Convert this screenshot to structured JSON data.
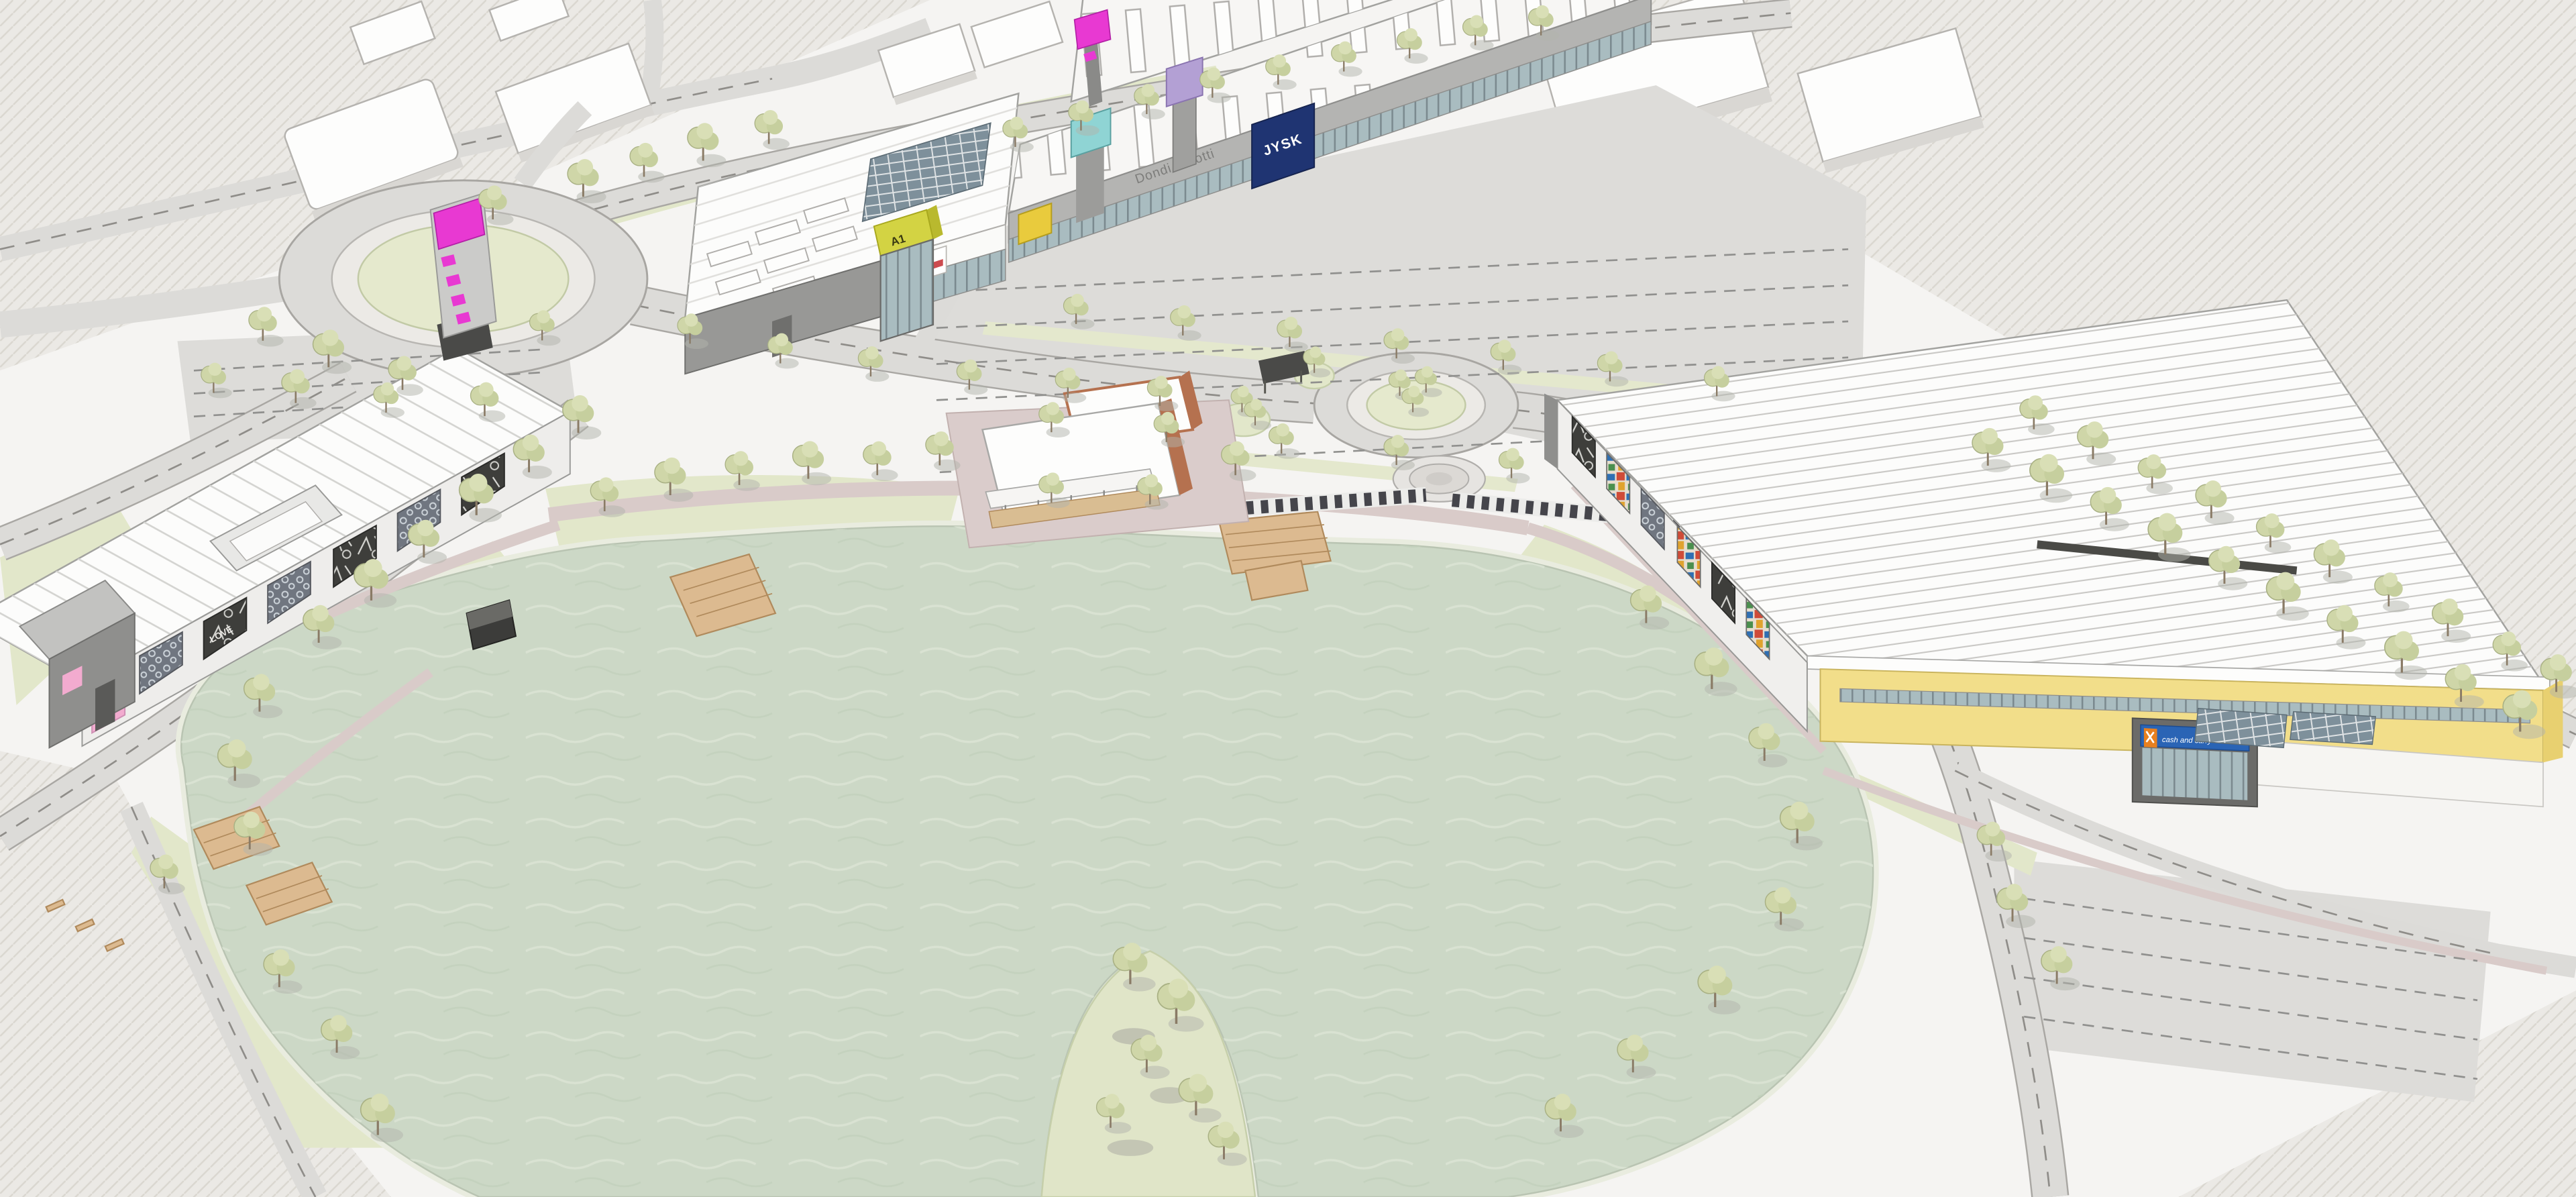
{
  "signs": {
    "b1": "B1",
    "a1": "A1",
    "dondi": "Dondi Salotti",
    "jysk": "JYSK",
    "cash_and_carry": "cash and carry",
    "love_graffiti": "LOVE"
  },
  "palette": {
    "water": "#ccd8c6",
    "grass": "#e2e7ca",
    "road": "#dcdbd8",
    "magenta_totem": "#e839d2",
    "a1_entrance_yellow": "#d3d343",
    "facade_yellow": "#f2de8a",
    "jysk_blue": "#1f3472",
    "cash_sign_blue": "#2a64b5",
    "cash_logo_orange": "#e8801f",
    "b1_label_pink": "#f2abcf",
    "terracotta": "#b5714f"
  }
}
